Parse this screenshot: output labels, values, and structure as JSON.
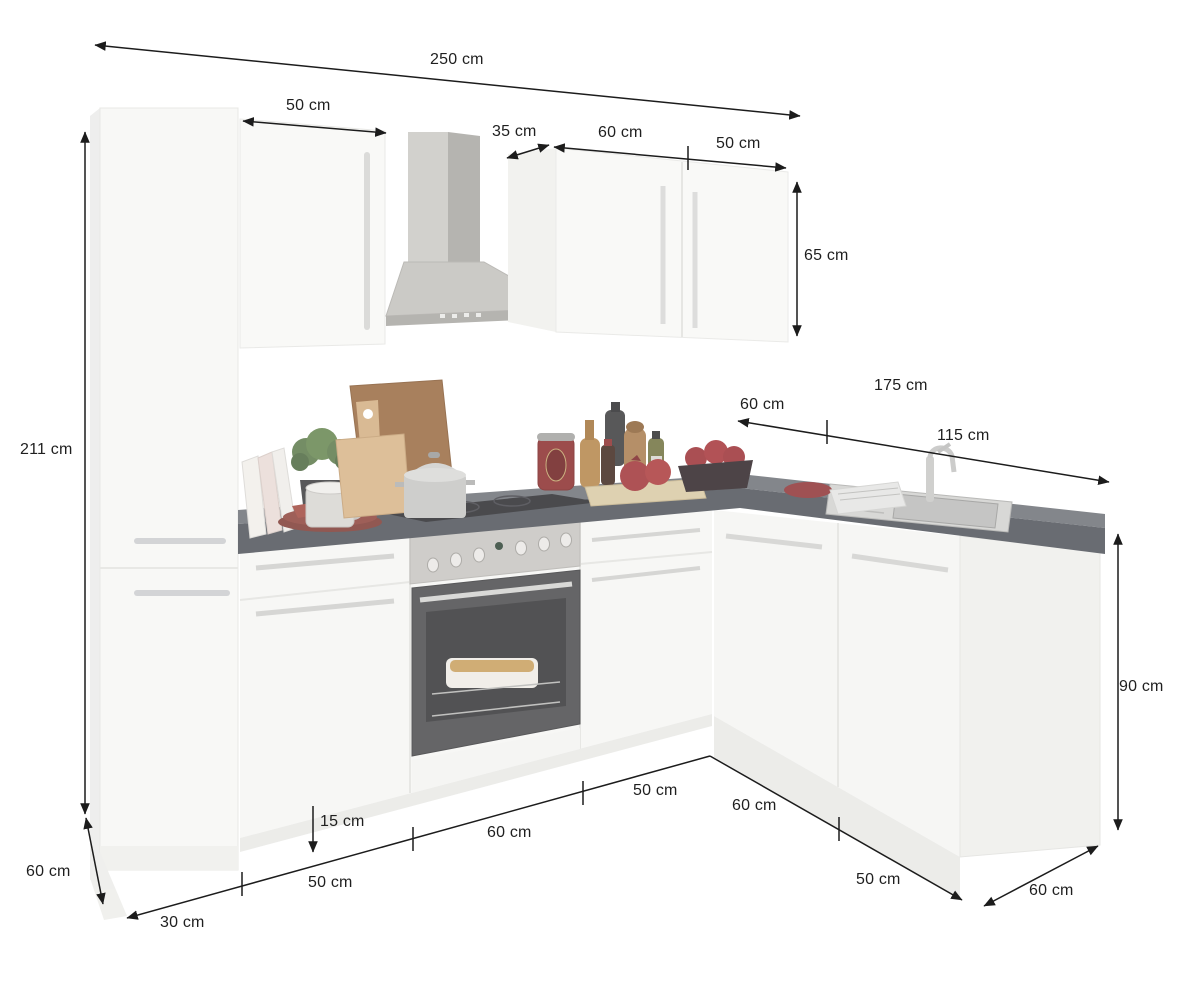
{
  "diagram": {
    "subject": "l-shaped-kitchen-with-dimensions",
    "units": "cm"
  },
  "colors": {
    "dimension_line": "#1c1c1c",
    "cabinet_white": "#f7f7f5",
    "counter_top": "#6e7177",
    "counter_edge": "#4f535a",
    "steel": "#c6c4c0",
    "accent_red": "#8f3336",
    "wood_light": "#d8b488",
    "wood_dark": "#996a41"
  },
  "dims": {
    "total_width": "250 cm",
    "wall_cabinet_left_width": "50 cm",
    "wall_cabinet_depth": "35 cm",
    "wall_cabinet_door_60": "60 cm",
    "wall_cabinet_door_50": "50 cm",
    "wall_cabinet_height": "65 cm",
    "tall_unit_height": "211 cm",
    "right_run_width": "175 cm",
    "right_run_corner": "60 cm",
    "right_run_sink": "115 cm",
    "base_unit_height": "90 cm",
    "left_run_depth": "60 cm",
    "plinth_height": "15 cm",
    "front_seg_1": "30 cm",
    "front_seg_2": "50 cm",
    "front_seg_3": "60 cm",
    "front_seg_4": "50 cm",
    "front_seg_5": "60 cm",
    "front_seg_6": "50 cm",
    "right_run_depth": "60 cm"
  }
}
